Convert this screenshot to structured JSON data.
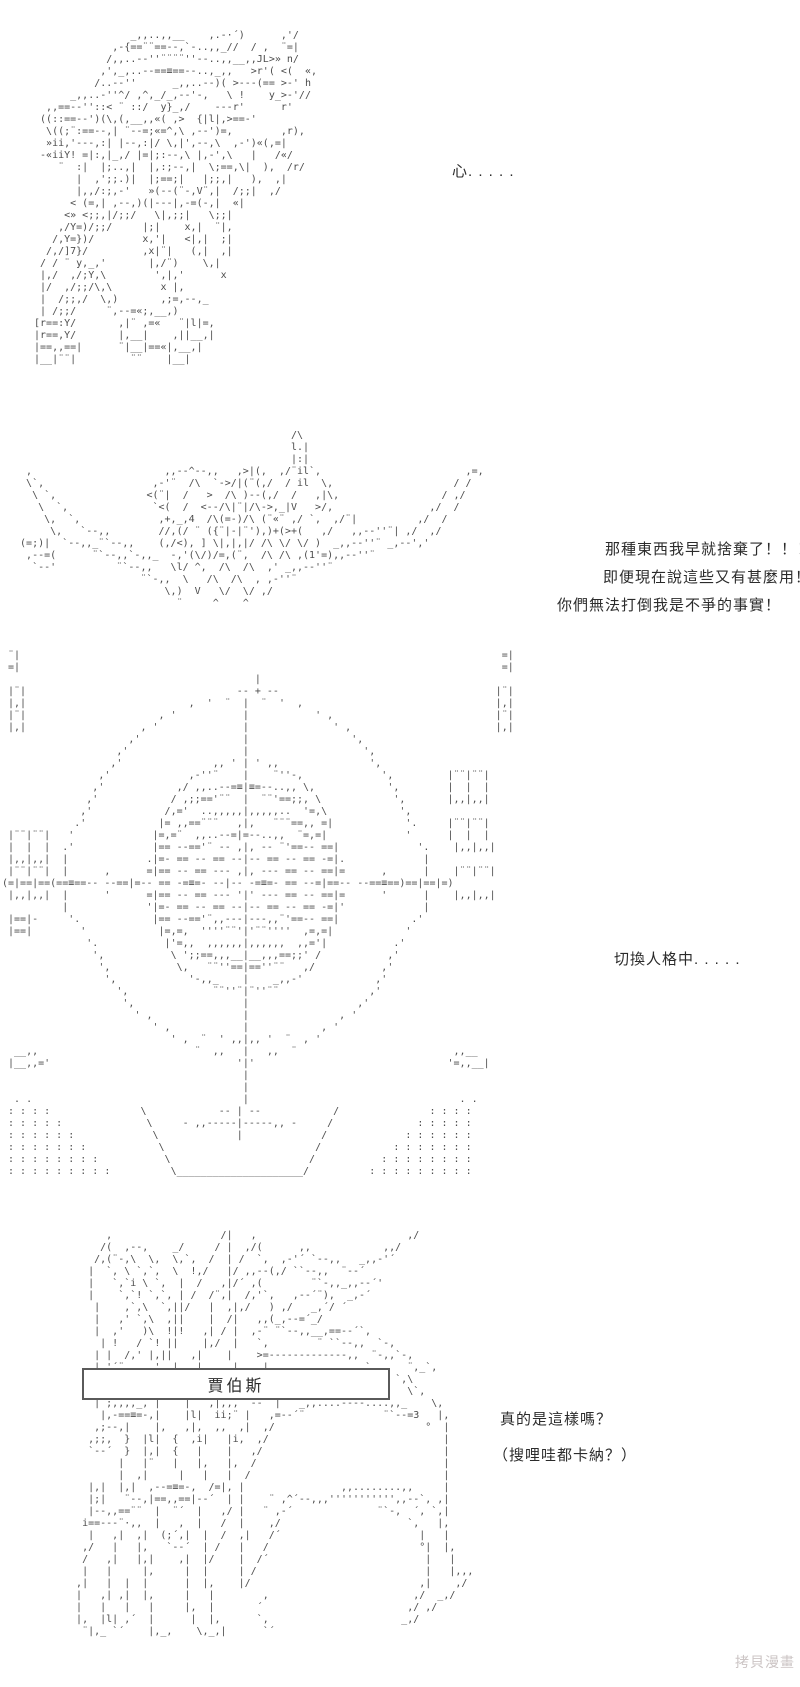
{
  "page": {
    "background": "#ffffff",
    "art_color": "#4d4d4d",
    "text_color": "#2b2b2b"
  },
  "dialogues": {
    "d1": "心. . . . .",
    "d2_lines": [
      "那種東西我早就捨棄了！！！",
      "即便現在說這些又有甚麼用！",
      "你們無法打倒我是不爭的事實！"
    ],
    "d3": "切換人格中. . . . .",
    "d4_lines": [
      "真的是這樣嗎？",
      "（搜哩哇都卡納？）"
    ]
  },
  "namebox": {
    "label": "賈伯斯"
  },
  "watermark": {
    "label": "拷貝漫畫",
    "color": "#ccc5c5"
  },
  "ascii_art": {
    "mecha": [
      "                 _,,..,,__    ,.-·´)      ,'/",
      "              ,-{==¨¨==--,`-..,,_//  / ,  ¨=|",
      "             /,,..--''¨¨¨¨''--..,,__,,JL>» n/",
      "            ,',_,..--==≡==--..,_,,   >r'( <(  «,",
      "           /..--''      _,,..--)( >---(== >-' h",
      "       _,,..-''^/ ,^,_/_,--'-,   \\ !    y_>-'//",
      "   ,,==--''::< ¨ ::/  y}_,/    ---r'      r'",
      "  ((::==--')(\\,(,__,,«( ,>  {|l|,>==-'",
      "   \\((;¨:==--,| ¨--=;«=^,\\ ,--')=,        ,r),",
      "   »ii,'---,:| |--,:|/ \\,|',--,\\  ,-')«(,=|",
      "  -«iiY! =|:,|_,/ |=|;:--,\\ |,-',\\   |   /«/",
      "     ¨  :|  |;..,|  |,:;--,|  \\;==,\\|  ),  /r/",
      "        |  ,';;.)|  |;==;|   |;;,|   ),  ,|",
      "        |,,/:;,-'   »(--(¨-,V¨,|  /;;|  ,/",
      "       < (=,| ,--,)(|---|,-=(-,|  «|",
      "      <» <;;,|/;;/   \\|,;;|   \\;;|",
      "     ,/Y=)/;;/     |;|    x,|  ¨|,",
      "    /,Y=})/        x,'|   <|,|  ;|",
      "   /,/]7}/         ,x|¨|   (,|  ,|",
      "  / / ¨ y,_,'       |,/¨)    \\,|",
      "  |,/  ,/;Y,\\        ',|,'      x",
      "  |/  ,/;;/\\,\\        x |,",
      "  |  /;;,/  \\,)       ,;=,--,_",
      "  | /;;/     ¨,--=«;,__,)",
      " [r==:Y/       ,|¨ ,=«   ¨|l|=,",
      " |r==,Y/       |,__|    ,||__,|",
      " |==,,==|      ¨|__|==«|,__,|",
      " |__|¨¨|         ¨¨    |__|"
    ],
    "winged_head": [
      "                                               /\\",
      "                                               l.|",
      "                                               |:|",
      "   ,                      ,,--^--,,   ,>|(,  ,/¨il`,                        ,=,",
      "   \\`,                  ,-'¨  /\\  `->/|(¨(,/  / il  \\,                    / /",
      "    \\ `,               <(¨|  /   >  /\\ )--(,/  /   ,|\\,                 / ,/",
      "     \\  `,              `<(  /  <--/\\|¨|/\\->,_|V   >/,                ,/  /",
      "      \\,  `,             ,+,_,4  /\\(=-)/\\ (¨«¨ ,/ `,  ,/¨|          ,/  /",
      "       \\,   `--,,        //,(/ ¨ ({¨|-|¨'),)+(>+(   ,/   ,,--''¨| ,/  ,/",
      "  (=;)|  `--,,_¨`--,,    (,/<), ] \\|,|,|/ /\\ \\/ \\/ )  _,,--''¨ _,--','",
      "   ,--=(      ¨`--,,`-,,_  -,'(\\/)/=,(¨,  /\\ /\\ ,(1'=),,--''¨",
      "    `--'          ¨`--,,   \\l/ ^,  /\\  /\\  ,' _,,--''¨",
      "                      ¨`-,,  \\   /\\  /\\  , ,-''¨",
      "                          \\,)  V   \\/  \\/ ,/",
      "                            ¨     ^    ^"
    ],
    "reticle": [
      " ¨|                                                                                =|",
      " =|                                                                                =|",
      "                                          |",
      " |¨|                                   -- + --                                    |¨|",
      " |,|                           ,  '  ¨  |  ¨  '  ,                                |,|",
      " |¨|                      , '           |           ' ,                           |¨|",
      " |,|                   , '              |              ' ,                        |,|",
      "                     ,'                 |                 ',",
      "                   ,'                   |                   ',",
      "                  ,'               ,, ' | ' ,,               ',",
      "                ,'             ,-''¨    |    ¨''-,             ',         |¨¨|¨¨|",
      "               ,'            ,/ ,,..--=≡|≡=--..,, \\,            ',        |  |  |",
      "              ,'            / ,;;=='¨¨  |  ¨¨'==;;, \\            ',       |,,|,,|",
      "             ,'            /,='  ..,,,,,|,,,,,..  '=,\\            ',",
      "            .'            |= ,,==¨¨¨   ,|,   ¨¨¨==,, =|            '.     |¨¨|¨¨|",
      " |¨¨|¨¨|   '             |=,=¨  ,,..--=|=--..,,  ¨=,=|             '      |  |  |",
      " |  |  |  .'             |== --=='¨ -- ,|, -- ¨'==-- ==|             '.    |,,|,,|",
      " |,,|,,|  |             .|=- == -- == --|-- == -- == -=|.             |",
      " |¨¨|¨¨|  |      ,      =|== -- == --- ,|, --- == -- ==|=      ,      |    |¨¨|¨¨|",
      "(=|==|==(==≡==-- --==|=-- == -=≡=- --|-- -=≡=- == --=|==-- --==≡==)==|==|=)",
      " |,,|,,|  |      '      =|== -- == --- '|' --- == -- ==|=      '      |    |,,|,,|",
      "          |             '|=- == -- == --|-- == -- == -=|'             |",
      " |==|-     '.            |== --=='¨,,---|---,,¨'==-- ==|            .'",
      " |==|        '            |=,=,  ''''¨¨'|'¨¨''''  ,=,=|            '",
      "              '.           |'=,,  ,,,,,,|,,,,,,  ,,='|           .'",
      "               ',           \\ ';;==,,,__|__,,,==;;' /           ,'",
      "                ',           \\,   ¨¨''==|==''¨¨   ,/           ,'",
      "                 ',            '-,,_    |    _,,-'            ,'",
      "                   ',              ¨¨''¨|¨''¨¨               ,'",
      "                    ',                  |                  ,'",
      "                      ' ,               |               , '",
      "                         ' ,            |            , '",
      "                            ' ,  ¨  ' ,,|,, '  ¨  , '",
      "  __,,                          ¨  ,,   |   ,,  ¨                          ,,__",
      " |__,,='                               '|'                                '=,,__|",
      "                                        |",
      "                                        |",
      "  . .                                   |                                   . .",
      " : : : :               \\            -- | --            /               : : : :",
      " : : : : :              \\     - ,,-----|-----,, -     /              : : : : :",
      " : : : : : :             \\             |             /             : : : : : :",
      " : : : : : : :            \\                         /            : : : : : : :",
      " : : : : : : : :           \\                       /           : : : : : : : :",
      " : : : : : : : : :          \\_____________________/          : : : : : : : : :"
    ],
    "cape_character": [
      "        ,                  /|   ,                         ,/",
      "       /(  ,--,    _/     / |  ,/(      ,,            ,,/",
      "      /,(¨-,\\  \\,  \\,`,  /  | /  `,  ,-'´ `--,,   _,,-'´",
      "     |  `, \\ `,`,  \\  !,/   |/ ,,--(,/ ``--,,  ¨--´",
      "     |   `,`i \\ `,  |  /   ,|/´ ,(        ¨`-,,_,,--´'",
      "     |    `,`! `,`, | /  /¨,|  /,'`,   ,--´¨),  _,-´",
      "      |    ,`,\\  `,||/   |  ,|,/   ) ,/   _,´/ ´",
      "      |   ,' `,\\  ,||    |  /|   ,,(_,--=´_/",
      "      |  ,'   )\\  !|!   ,| / |  ,-¨ ¨`--,,__,==--´`,",
      "       | !   / `! ||    |,/  |   `,        ¨ ``--,,  `-,",
      "      | |  /,' |,||   ,|    |    >=-------------,,  ¨-,,`-,",
      "      |,'´¨,,,_,'  |   |,    |    |,_,,,....,,,,_  `,     ¨,_`,",
      "                                                        `,\\",
      "                                                          \\`,",
      "      |´;,,,,_,´|    |   ,|,,,  --  |   _,,....----....,,_    \\,",
      "       |,-==≡=-,|    |l|  ii;¨ |   ,=--´¨             ¨`--=3   |,",
      "      ,;--,|    |,   ,|,  ,,  ,|  ,/                         °  |",
      "     ,;;,  }  |l|  {  ,i|   |i,  ,/                             |",
      "     `--´  }  |,|  {   |    |   ,/                              |",
      "          |   |¨   |   |,   |,  /                               |",
      "          |  ,|     |   |   |  /                                |",
      "     |,|  |,|  ,--=≡=-,  /=|, |                ,,........,,     |",
      "     |;|   ¨--,|==,,==|--´  | |    ¨ ,^´--,,,''''''''''',,--`, ,|",
      "     |--,,==¨¨  |  ¨´  |   ,/ |   ¨ ,-´              ¨`-,  ´, `,|",
      "    i==---¨·,,  |   ,  |   /  |    ,/                     `,   |,",
      "     |   ,|  ,|  (;´,|  |  /  ,|   /´                       |   |",
      "    ,/   |   |,   `--´  | /   |   /                         °|  |,",
      "    /   ,|   |,|    ,|  |/    |  /´                          |   |",
      "    |   |     |,     |  |     | /                            |   |,,,",
      "   ,|   |  |  |      |  |,    |/                            ,|    ,/",
      "   |   ,| ,|  |,     |   |        ,                        ,/  _,/",
      "   |   |   |   |     |,  |       ´                        ,/ ,/",
      "   |,  |l| ,´  |      |  |,      `,                      _,/",
      "    ¨|,_ `´    |,_,    \\,_,|      `´"
    ]
  }
}
